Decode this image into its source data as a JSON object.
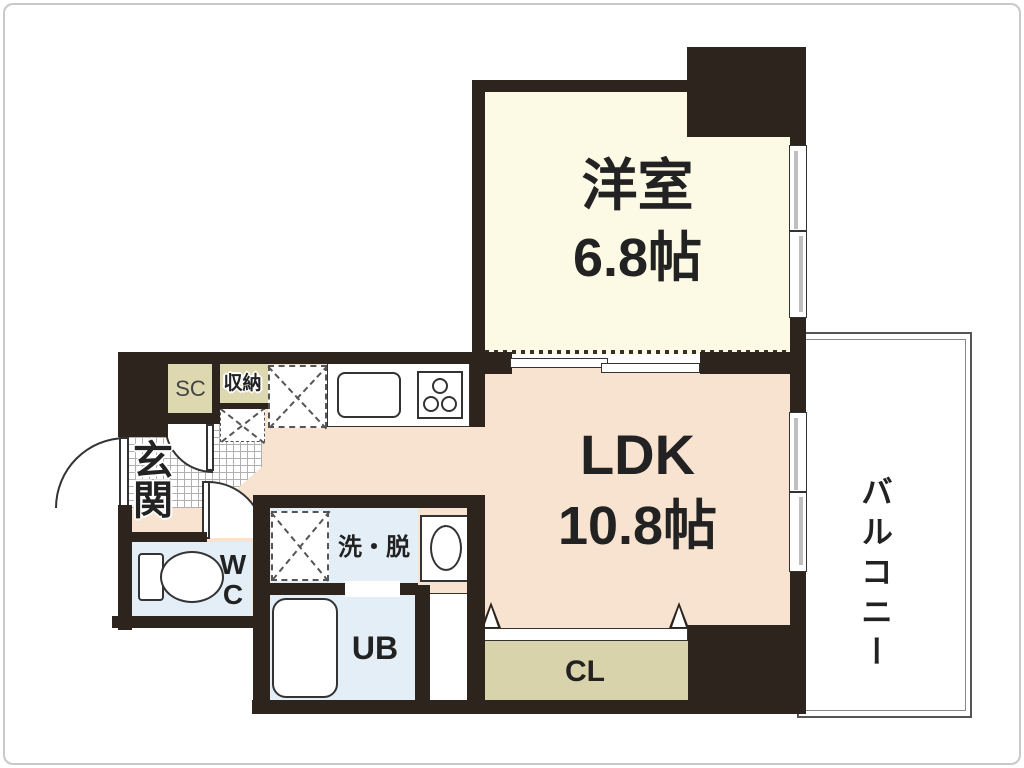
{
  "rooms": {
    "western_room": {
      "label": "洋室",
      "size": "6.8帖"
    },
    "ldk": {
      "label": "LDK",
      "size": "10.8帖"
    },
    "balcony": {
      "label": "バルコニー"
    },
    "entrance": {
      "label": "玄関"
    },
    "shoe_closet": {
      "label": "SC"
    },
    "storage": {
      "label": "収納"
    },
    "toilet": {
      "label_line1": "W",
      "label_line2": "C"
    },
    "wash_dressing_room": {
      "label": "洗・脱"
    },
    "unit_bath": {
      "label": "UB"
    },
    "closet": {
      "label": "CL"
    }
  },
  "fixtures": [
    "toilet",
    "bathtub",
    "wash-basin",
    "kitchen-sink",
    "gas-stove",
    "refrigerator-space",
    "washer-space",
    "entrance-door",
    "sliding-partition",
    "balcony-rail"
  ],
  "colors": {
    "wall": "#2d241e",
    "western_room_floor": "#fcf9e4",
    "ldk_floor": "#f8e3d1",
    "wet_room_floor": "#e4eef7",
    "closet_tan": "#d9d3ab",
    "outline": "#333333"
  }
}
